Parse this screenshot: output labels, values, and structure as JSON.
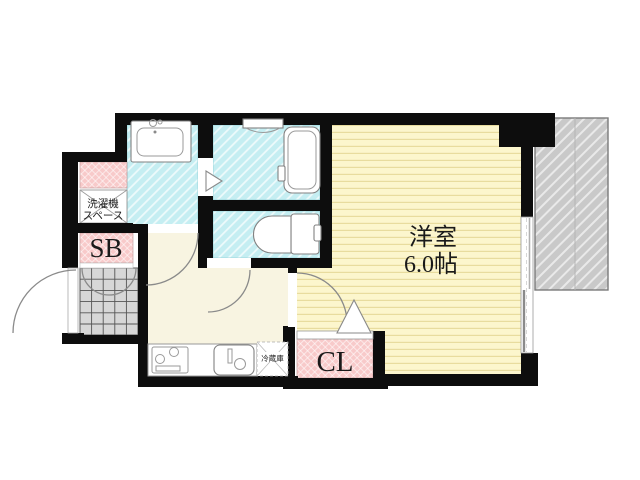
{
  "floorplan": {
    "labels": {
      "western_room_name": "洋室",
      "western_room_size": "6.0帖",
      "closet": "CL",
      "shoe_box": "SB",
      "washing_machine_line1": "洗濯機",
      "washing_machine_line2": "スペース",
      "refrigerator": "冷蔵庫"
    },
    "rooms": {
      "western_room": {
        "name": "洋室",
        "size_tatami": "6.0帖",
        "fill": "#fcf6cd",
        "stripe": "#e8dc9e"
      },
      "kitchen_hall": {
        "fill": "#f8f4e1"
      },
      "bathroom": {
        "fill": "#c5eef2"
      },
      "toilet": {
        "fill": "#c5eef2"
      },
      "washbasin_room": {
        "fill": "#c5eef2"
      },
      "closet": {
        "label": "CL",
        "fill": "#f8caca"
      },
      "shoe_box": {
        "label": "SB",
        "fill": "#f8caca"
      },
      "washing_machine_space": {
        "label": "洗濯機スペース",
        "fill": "#ffffff"
      },
      "entrance": {
        "fill": "#d7d7d7"
      },
      "neighbor_area": {
        "fill": "#c9c9c9"
      }
    },
    "colors": {
      "wall": "#0d0d0d",
      "door_arc": "#8a8a8a",
      "fixture_outline": "#828282",
      "tile_grid_line": "#555555"
    }
  }
}
